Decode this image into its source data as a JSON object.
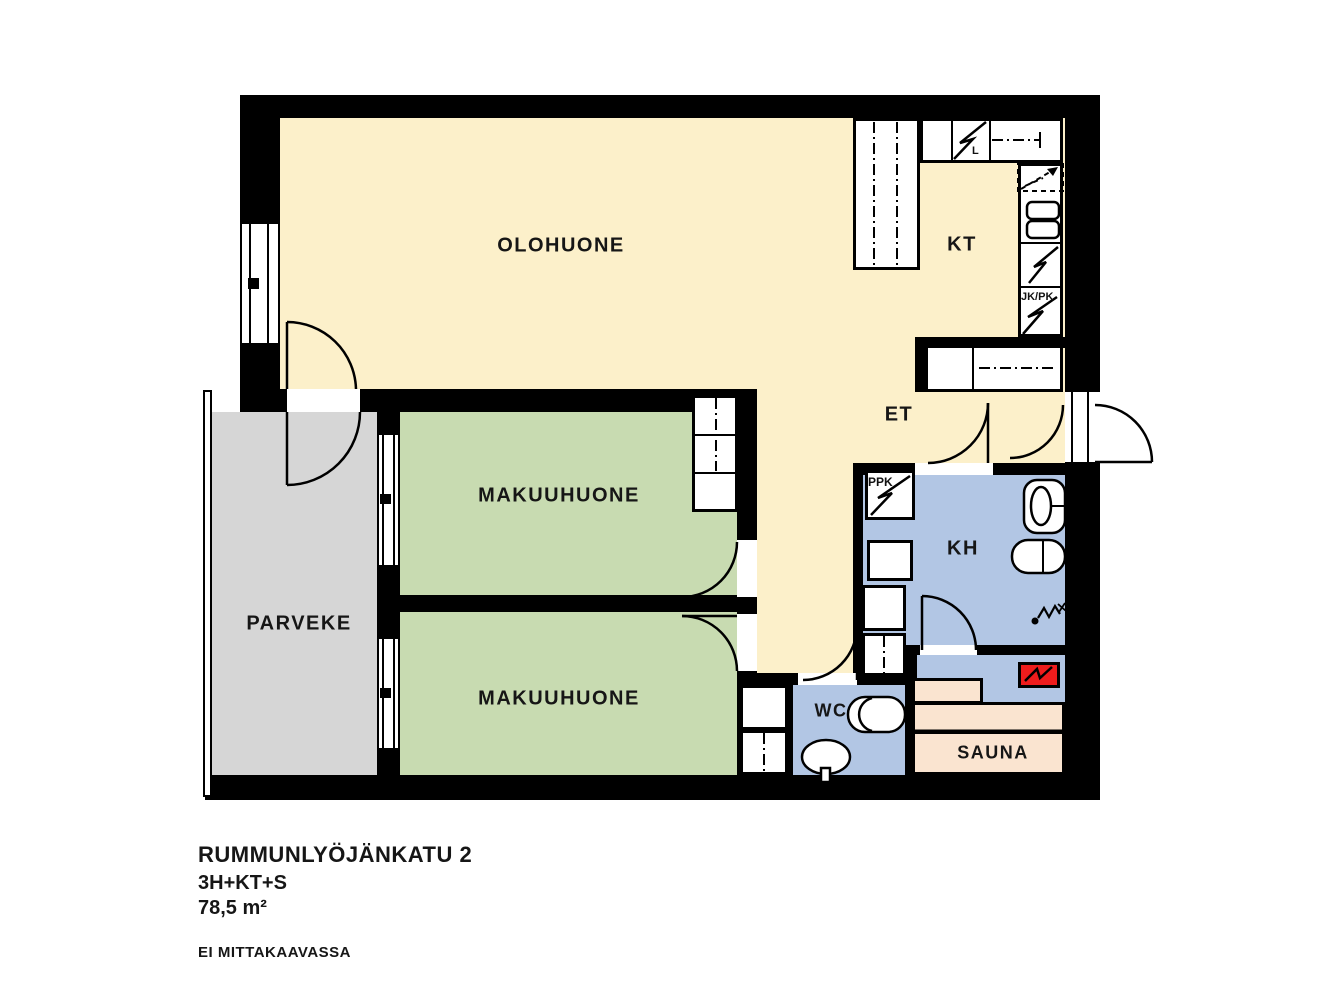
{
  "plan": {
    "rooms": {
      "olohuone": "OLOHUONE",
      "kt": "KT",
      "et": "ET",
      "kh": "KH",
      "wc": "WC",
      "sauna": "SAUNA",
      "parveke": "PARVEKE",
      "makuuhuone1": "MAKUUHUONE",
      "makuuhuone2": "MAKUUHUONE"
    },
    "labels": {
      "ppk": "PPK",
      "jkpk": "JK/PK",
      "liesi": "L"
    },
    "colors": {
      "living_floor": "#FCF0CA",
      "bedroom_floor": "#C8DBB1",
      "wet_floor": "#B2C6E4",
      "sauna_floor": "#FAE4D0",
      "balcony_floor": "#D6D6D6",
      "stove_red": "#EE1C1C",
      "wall": "#000000"
    }
  },
  "footer": {
    "address": "RUMMUNLYÖJÄNKATU 2",
    "layout_code": "3H+KT+S",
    "area": "78,5 m²",
    "note": "EI MITTAKAAVASSA"
  }
}
